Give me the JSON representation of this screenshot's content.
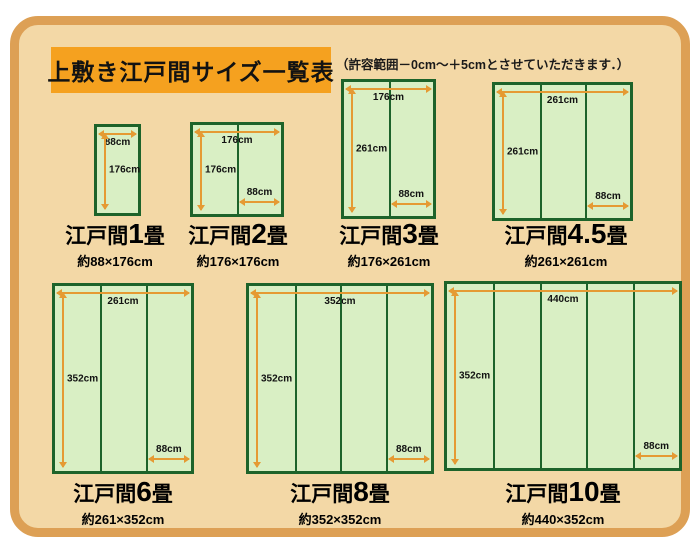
{
  "header": {
    "title": "上敷き江戸間サイズ一覧表",
    "note": "（許容範囲－0cm～＋5cmとさせていただきます．）"
  },
  "colors": {
    "frame_border": "#dda055",
    "background": "#f3d8a6",
    "title_box": "#f5a11f",
    "mat_fill": "#d9efc4",
    "mat_border": "#1d632a",
    "arrow": "#e59a33"
  },
  "mats": [
    {
      "id": "1jo",
      "series": "江戸間",
      "count": "1",
      "unit": "畳",
      "size": "約88×176cm",
      "width_cm": 88,
      "height_cm": 176,
      "panels": 1,
      "top_label": "88cm",
      "left_label": "176cm",
      "bottom_label": ""
    },
    {
      "id": "2jo",
      "series": "江戸間",
      "count": "2",
      "unit": "畳",
      "size": "約176×176cm",
      "width_cm": 176,
      "height_cm": 176,
      "panels": 2,
      "top_label": "176cm",
      "left_label": "176cm",
      "bottom_label": "88cm"
    },
    {
      "id": "3jo",
      "series": "江戸間",
      "count": "3",
      "unit": "畳",
      "size": "約176×261cm",
      "width_cm": 176,
      "height_cm": 261,
      "panels": 2,
      "top_label": "176cm",
      "left_label": "261cm",
      "bottom_label": "88cm"
    },
    {
      "id": "4.5jo",
      "series": "江戸間",
      "count": "4.5",
      "unit": "畳",
      "size": "約261×261cm",
      "width_cm": 261,
      "height_cm": 261,
      "panels": 3,
      "top_label": "261cm",
      "left_label": "261cm",
      "bottom_label": "88cm"
    },
    {
      "id": "6jo",
      "series": "江戸間",
      "count": "6",
      "unit": "畳",
      "size": "約261×352cm",
      "width_cm": 261,
      "height_cm": 352,
      "panels": 3,
      "top_label": "261cm",
      "left_label": "352cm",
      "bottom_label": "88cm"
    },
    {
      "id": "8jo",
      "series": "江戸間",
      "count": "8",
      "unit": "畳",
      "size": "約352×352cm",
      "width_cm": 352,
      "height_cm": 352,
      "panels": 4,
      "top_label": "352cm",
      "left_label": "352cm",
      "bottom_label": "88cm"
    },
    {
      "id": "10jo",
      "series": "江戸間",
      "count": "10",
      "unit": "畳",
      "size": "約440×352cm",
      "width_cm": 440,
      "height_cm": 352,
      "panels": 5,
      "top_label": "440cm",
      "left_label": "352cm",
      "bottom_label": "88cm"
    }
  ]
}
